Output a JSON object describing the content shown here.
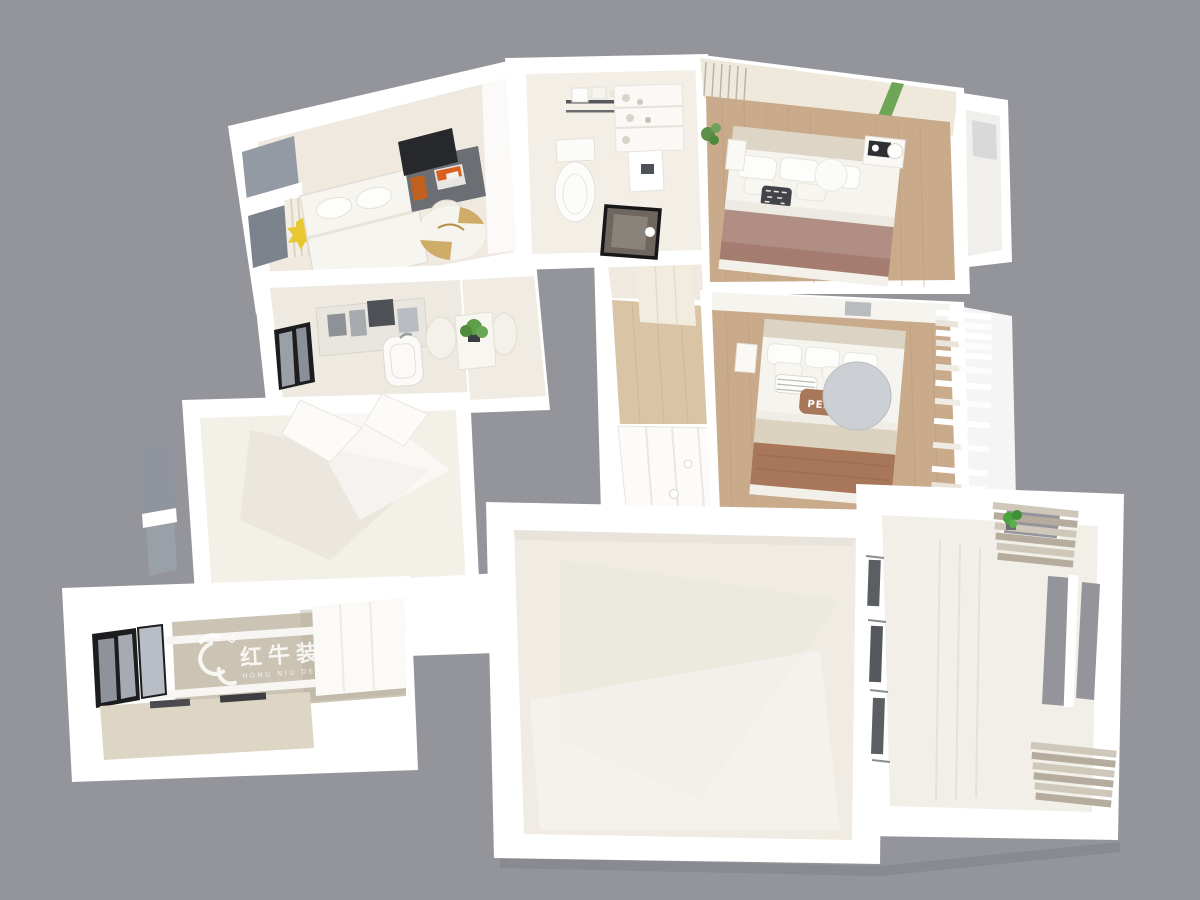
{
  "scene": {
    "description": "3D dollhouse-style rendered apartment floor plan viewed from above on a gray backdrop",
    "background_color": "#94949b"
  },
  "watermark": {
    "icon": "bull-logo-icon",
    "logo_cn": "红牛装饰",
    "logo_en": "HONG NIU DECORATION",
    "color": "#ffffff"
  },
  "second_bedroom": {
    "pillow_text": "PEACE"
  },
  "colors": {
    "background": "#94949b",
    "wall": "#ffffff",
    "floor_cream": "#f0ece3",
    "floor_bath": "#f3efe7",
    "wood": "#c9aa8a",
    "wood_light": "#d9c4a6",
    "duvet_mauve": "#b18e84",
    "duvet_brown": "#a87658",
    "blanket_beige": "#dbd2c0",
    "accent_green": "#5f9e49",
    "plant_green": "#4aa33c",
    "rug_gold": "#c8a050",
    "curtain_beige": "#b5ac9e",
    "curtain_light": "#cfc8ba",
    "frame_black": "#1d1d20",
    "glass_gray": "#939aa3",
    "lamp_gray": "#ccd0d4",
    "logo_wall": "#cbc3b3"
  }
}
